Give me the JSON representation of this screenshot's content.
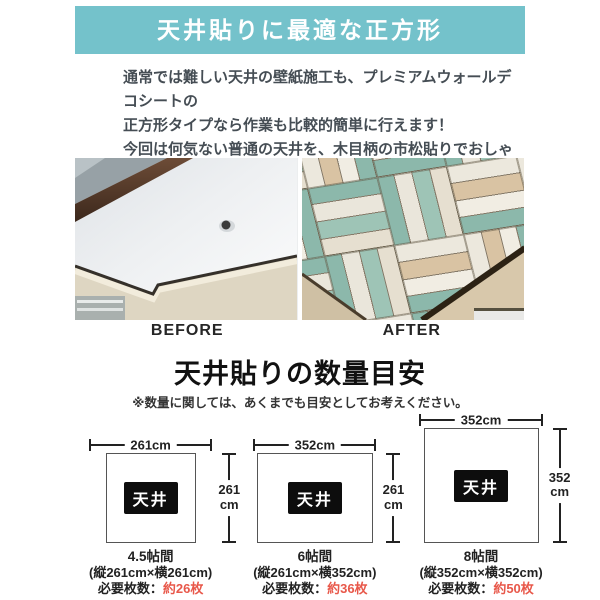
{
  "colors": {
    "banner_bg": "#74c2cb",
    "accent_red": "#e8584a",
    "plank_teal": "#8cb8ab",
    "plank_cream": "#eae6db",
    "plank_tan": "#d9c3a3",
    "wall_beige": "#ded6c2"
  },
  "banner": {
    "title": "天井貼りに最適な正方形"
  },
  "intro": {
    "lines": [
      "通常では難しい天井の壁紙施工も、プレミアムウォールデコシートの",
      "正方形タイプなら作業も比較的簡単に行えます！",
      "今回は何気ない普通の天井を、木目柄の市松貼りでおしゃれに",
      "アレンジしました♪"
    ]
  },
  "comparison": {
    "before_label": "BEFORE",
    "after_label": "AFTER"
  },
  "quantity_section": {
    "heading": "天井貼りの数量目安",
    "note": "※数量に関しては、あくまでも目安としてお考えください。",
    "ceiling_label": "天井",
    "diagrams": [
      {
        "room": "4.5帖間",
        "width_label": "261cm",
        "height_value": "261",
        "height_unit": "cm",
        "dimensions": "(縦261cm×横261cm)",
        "sheets_label": "必要枚数：",
        "sheets_value": "約26枚"
      },
      {
        "room": "6帖間",
        "width_label": "352cm",
        "height_value": "261",
        "height_unit": "cm",
        "dimensions": "(縦261cm×横352cm)",
        "sheets_label": "必要枚数：",
        "sheets_value": "約36枚"
      },
      {
        "room": "8帖間",
        "width_label": "352cm",
        "height_value": "352",
        "height_unit": "cm",
        "dimensions": "(縦352cm×横352cm)",
        "sheets_label": "必要枚数：",
        "sheets_value": "約50枚"
      }
    ]
  }
}
